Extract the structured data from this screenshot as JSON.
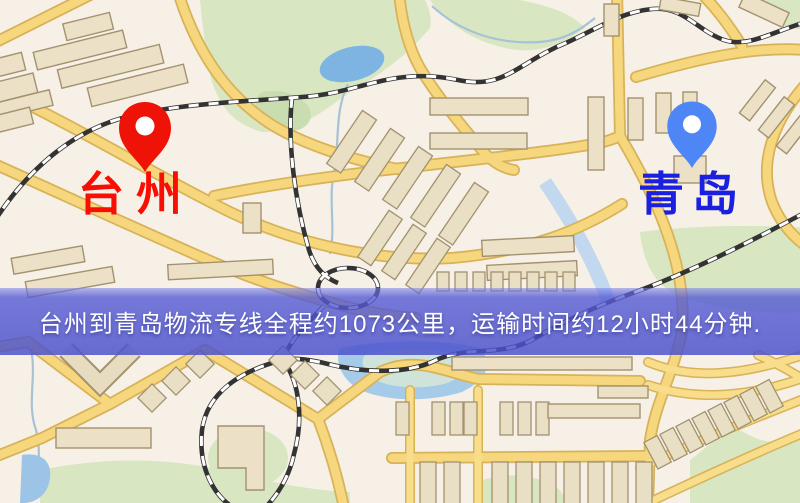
{
  "map": {
    "markers": [
      {
        "id": "origin",
        "label": "台州",
        "pin_color": "#ee1207",
        "pin_dot_color": "#ffffff",
        "label_color": "#fa0e03"
      },
      {
        "id": "destination",
        "label": "青岛",
        "pin_color": "#4e86f5",
        "pin_dot_color": "#ffffff",
        "label_color": "#1b1fe0"
      }
    ],
    "style_colors": {
      "background": "#f7f0e6",
      "road": "#f6d77d",
      "road_casing": "#d8b259",
      "railway": "#333333",
      "park": "#d8e6c2",
      "water": "#7db4e2",
      "building": "#ece1c6"
    }
  },
  "banner": {
    "text": "台州到青岛物流专线全程约1073公里，运输时间约12小时44分钟.",
    "background_color": "#4a50cc",
    "text_color": "#ffffff"
  },
  "route": {
    "origin": "台州",
    "destination": "青岛",
    "distance": "约1073公里",
    "duration": "约12小时44分钟"
  }
}
